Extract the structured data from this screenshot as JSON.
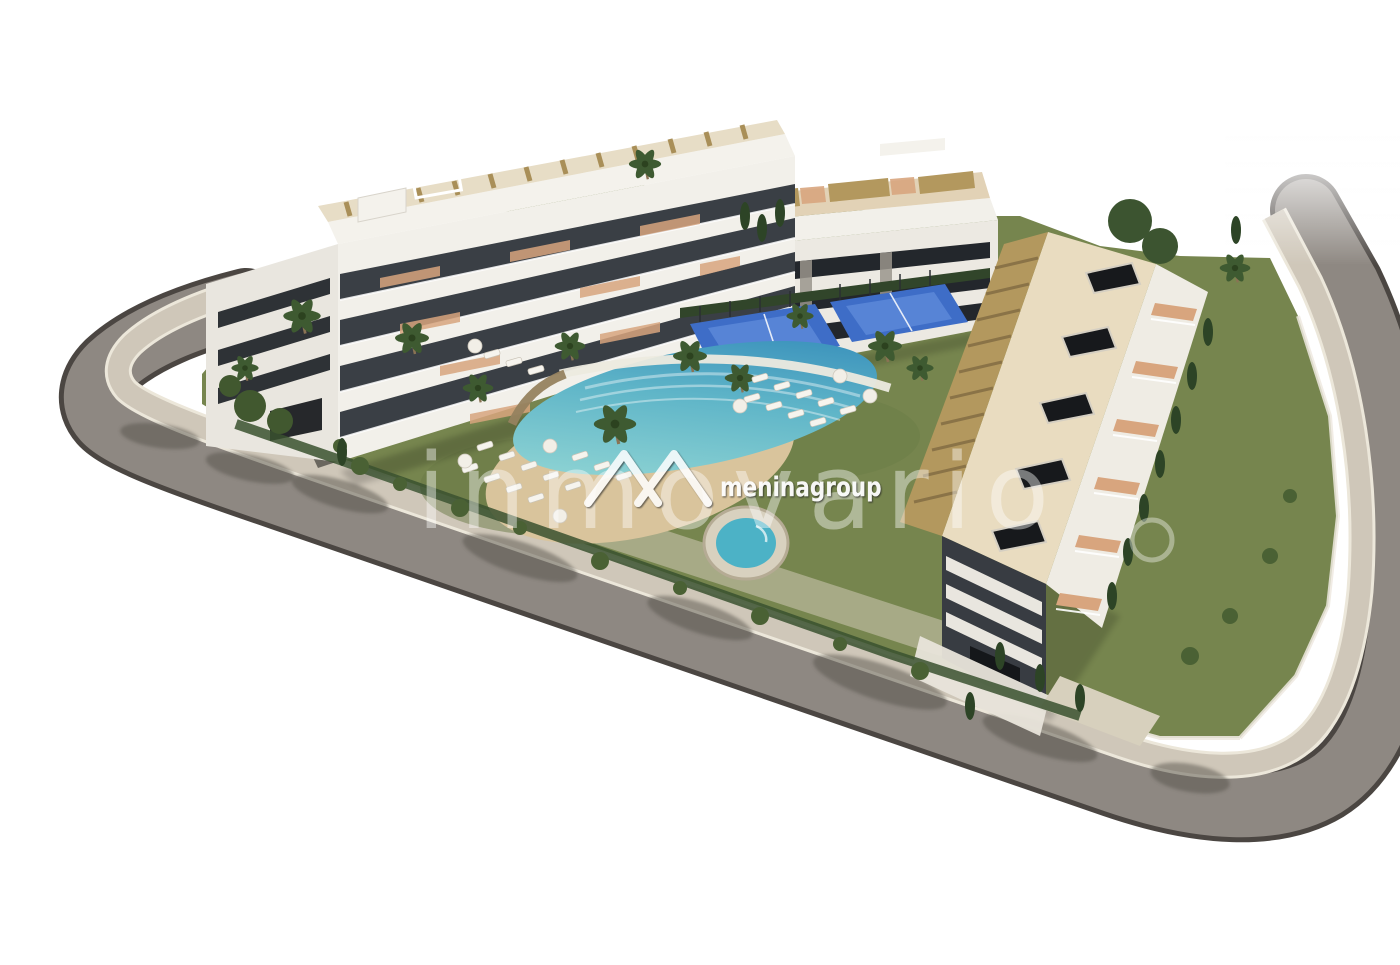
{
  "image": {
    "alt": "Aerial 3D architectural rendering of a white apartment complex with rooftop pergolas, landscaped gardens, a lagoon-style pool with sand beach, a round spa pool, blue padel courts and a curved perimeter ring road, on a white background"
  },
  "watermarks": {
    "large": "inmovario",
    "brand": "meninagroup",
    "logo": "mountain-peaks-logo"
  },
  "palette": {
    "background": "#ffffff",
    "road_asphalt": "#8e8882",
    "road_curb": "#4b4642",
    "sidewalk": "#cfc7b9",
    "grass": "#76854e",
    "hedge_green": "#3a512f",
    "tree_green": "#3e5a31",
    "cypress_green": "#2d4426",
    "building_white": "#f2f0ea",
    "window_band_dark": "#3a3f45",
    "pergola_tan": "#b3985e",
    "roof_cream": "#e9dcc0",
    "terrace_terracotta": "#d8a57e",
    "sand": "#d9c49c",
    "water_shallow": "#9adbd6",
    "water_deep": "#2f86b8",
    "round_pool_water": "#4cb2c6",
    "padel_blue": "#3e6dc7",
    "watermark_white": "#ffffff"
  }
}
